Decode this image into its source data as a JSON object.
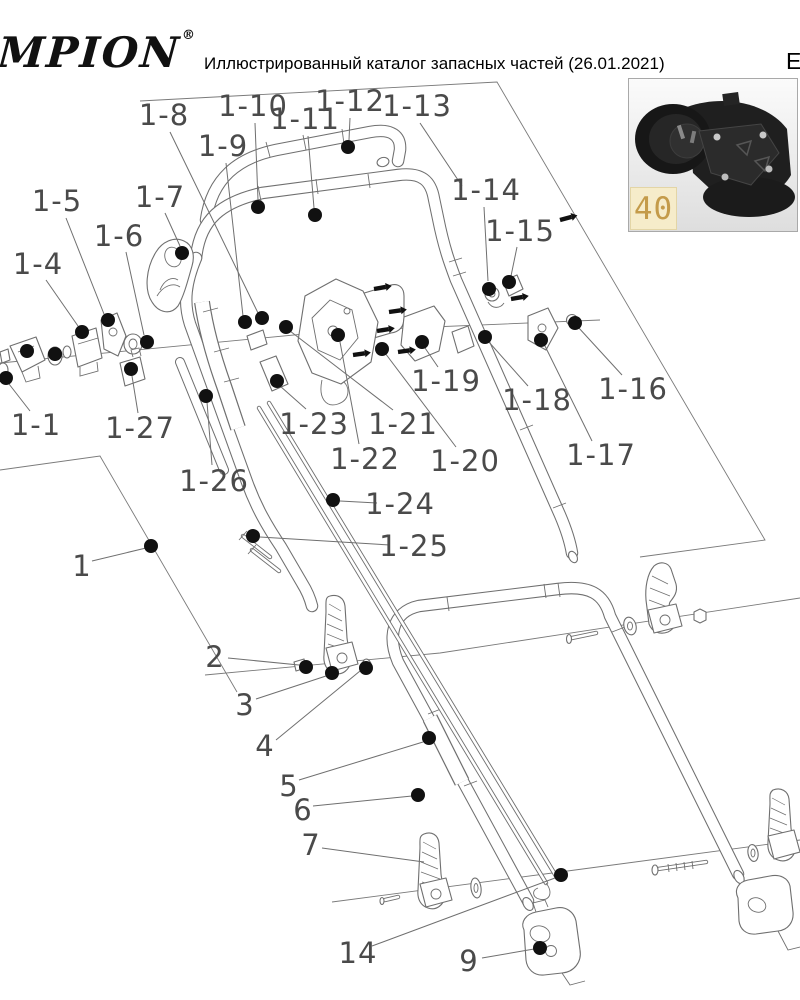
{
  "page": {
    "logo_text": "MPION",
    "logo_registered": "®",
    "title": "Иллюстрированный каталог запасных частей (26.01.2021)",
    "corner_letter": "Е"
  },
  "inset": {
    "part_number": "40",
    "label_bg": "#f6ecca",
    "label_text_color": "#c49b4a",
    "photo_subject": "black plastic mower housing part"
  },
  "diagram": {
    "line_color": "#6f6f6f",
    "label_color": "#4a4a4a",
    "dot_color": "#111111",
    "labels": [
      {
        "t": "1-8",
        "x": 164,
        "y": 115,
        "l": [
          170,
          132,
          258,
          313
        ],
        "d": [
          262,
          318
        ]
      },
      {
        "t": "1-9",
        "x": 223,
        "y": 146,
        "l": [
          226,
          163,
          243,
          316
        ],
        "d": [
          245,
          322
        ]
      },
      {
        "t": "1-10",
        "x": 253,
        "y": 106,
        "l": [
          255,
          123,
          258,
          200
        ],
        "d": [
          258,
          207
        ]
      },
      {
        "t": "1-11",
        "x": 305,
        "y": 119,
        "l": [
          308,
          136,
          314,
          208
        ],
        "d": [
          315,
          215
        ]
      },
      {
        "t": "1-12",
        "x": 350,
        "y": 101,
        "l": [
          350,
          118,
          349,
          140
        ],
        "d": [
          348,
          147
        ]
      },
      {
        "t": "1-13",
        "x": 417,
        "y": 106,
        "l": [
          420,
          123,
          462,
          186
        ],
        "d": null
      },
      {
        "t": "1-7",
        "x": 160,
        "y": 197,
        "l": [
          165,
          213,
          180,
          246
        ],
        "d": [
          182,
          253
        ]
      },
      {
        "t": "1-5",
        "x": 57,
        "y": 201,
        "l": [
          66,
          218,
          104,
          314
        ],
        "d": [
          108,
          320
        ]
      },
      {
        "t": "1-6",
        "x": 119,
        "y": 236,
        "l": [
          126,
          252,
          144,
          335
        ],
        "d": [
          147,
          342
        ]
      },
      {
        "t": "1-4",
        "x": 38,
        "y": 264,
        "l": [
          46,
          280,
          78,
          326
        ],
        "d": [
          82,
          332
        ]
      },
      {
        "t": "1-14",
        "x": 486,
        "y": 190,
        "l": [
          484,
          207,
          488,
          281
        ],
        "d": [
          489,
          289
        ]
      },
      {
        "t": "1-15",
        "x": 520,
        "y": 231,
        "l": [
          517,
          247,
          511,
          276
        ],
        "d": [
          509,
          282
        ]
      },
      {
        "t": "1-1",
        "x": 36,
        "y": 425,
        "l": [
          30,
          411,
          9,
          384
        ],
        "d": [
          6,
          378
        ]
      },
      {
        "t": "1-27",
        "x": 140,
        "y": 428,
        "l": [
          138,
          413,
          132,
          376
        ],
        "d": [
          131,
          369
        ]
      },
      {
        "t": "1-23",
        "x": 314,
        "y": 424,
        "l": [
          306,
          409,
          280,
          386
        ],
        "d": [
          277,
          381
        ]
      },
      {
        "t": "1-21",
        "x": 403,
        "y": 424,
        "l": [
          393,
          410,
          290,
          331
        ],
        "d": [
          286,
          327
        ]
      },
      {
        "t": "1-22",
        "x": 365,
        "y": 459,
        "l": [
          359,
          444,
          340,
          342
        ],
        "d": [
          338,
          335
        ]
      },
      {
        "t": "1-20",
        "x": 465,
        "y": 461,
        "l": [
          456,
          447,
          385,
          353
        ],
        "d": [
          382,
          349
        ]
      },
      {
        "t": "1-19",
        "x": 446,
        "y": 381,
        "l": [
          438,
          367,
          425,
          348
        ],
        "d": [
          422,
          342
        ]
      },
      {
        "t": "1-18",
        "x": 537,
        "y": 400,
        "l": [
          528,
          386,
          488,
          341
        ],
        "d": [
          485,
          337
        ]
      },
      {
        "t": "1-16",
        "x": 633,
        "y": 389,
        "l": [
          622,
          375,
          578,
          327
        ],
        "d": [
          575,
          323
        ]
      },
      {
        "t": "1-17",
        "x": 601,
        "y": 455,
        "l": [
          592,
          441,
          544,
          344
        ],
        "d": [
          541,
          340
        ]
      },
      {
        "t": "1-26",
        "x": 214,
        "y": 481,
        "l": [
          212,
          465,
          207,
          402
        ],
        "d": [
          206,
          396
        ]
      },
      {
        "t": "1-24",
        "x": 400,
        "y": 504,
        "l": [
          377,
          503,
          340,
          501
        ],
        "d": [
          333,
          500
        ]
      },
      {
        "t": "1-25",
        "x": 414,
        "y": 546,
        "l": [
          390,
          545,
          260,
          537
        ],
        "d": [
          253,
          536
        ]
      },
      {
        "t": "1",
        "x": 82,
        "y": 566,
        "l": [
          92,
          561,
          146,
          548
        ],
        "d": [
          151,
          546
        ]
      },
      {
        "t": "2",
        "x": 215,
        "y": 657,
        "l": [
          228,
          658,
          299,
          665
        ],
        "d": [
          306,
          667
        ]
      },
      {
        "t": "3",
        "x": 245,
        "y": 705,
        "l": [
          256,
          699,
          326,
          676
        ],
        "d": [
          332,
          673
        ]
      },
      {
        "t": "4",
        "x": 265,
        "y": 746,
        "l": [
          276,
          740,
          360,
          671
        ],
        "d": [
          366,
          668
        ]
      },
      {
        "t": "5",
        "x": 289,
        "y": 786,
        "l": [
          299,
          780,
          423,
          742
        ],
        "d": [
          429,
          738
        ]
      },
      {
        "t": "6",
        "x": 303,
        "y": 810,
        "l": [
          313,
          806,
          412,
          796
        ],
        "d": [
          418,
          795
        ]
      },
      {
        "t": "7",
        "x": 311,
        "y": 845,
        "l": [
          322,
          848,
          424,
          862
        ],
        "d": null
      },
      {
        "t": "14",
        "x": 358,
        "y": 953,
        "l": [
          372,
          946,
          555,
          878
        ],
        "d": [
          561,
          875
        ]
      },
      {
        "t": "9",
        "x": 469,
        "y": 961,
        "l": [
          482,
          958,
          534,
          949
        ],
        "d": [
          540,
          948
        ]
      }
    ],
    "extra_dots": [
      [
        27,
        351
      ],
      [
        55,
        354
      ]
    ],
    "screws": [
      [
        374,
        289,
        -10
      ],
      [
        389,
        312,
        -8
      ],
      [
        377,
        331,
        -9
      ],
      [
        398,
        352,
        -8
      ],
      [
        353,
        355,
        -8
      ],
      [
        511,
        299,
        -10
      ],
      [
        560,
        220,
        -15
      ]
    ]
  }
}
